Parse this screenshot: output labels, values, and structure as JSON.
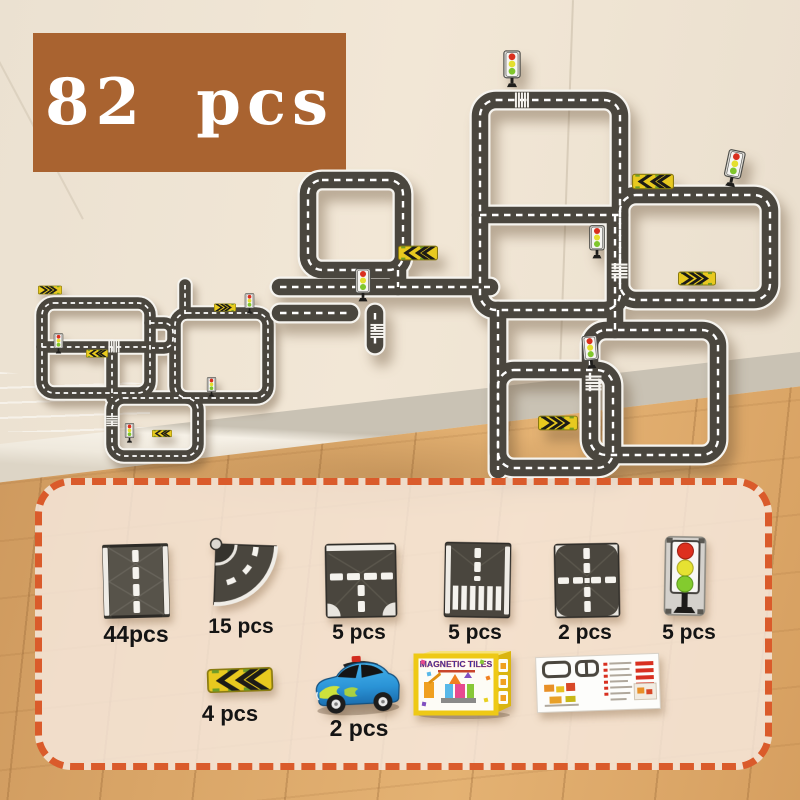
{
  "badge": {
    "label": "82 pcs",
    "bg_color": "#a96330",
    "text_color": "#ffffff"
  },
  "scene": {
    "wall_color": "#ece2d2",
    "skirting_color": "#f3eee3",
    "floor_color": "#d8a263",
    "road_color": "#4a463e",
    "road_line_color": "#ffffff",
    "panel_border_color": "#da5b2b"
  },
  "panel": {
    "items": [
      {
        "id": "straight-road-tile",
        "count": "44pcs"
      },
      {
        "id": "curve-road-tile",
        "count": "15 pcs"
      },
      {
        "id": "t-junction-tile",
        "count": "5 pcs"
      },
      {
        "id": "crosswalk-tile",
        "count": "5 pcs"
      },
      {
        "id": "cross-intersection-tile",
        "count": "2 pcs"
      },
      {
        "id": "traffic-light",
        "count": "5 pcs"
      },
      {
        "id": "chevron-sign",
        "count": "4 pcs"
      },
      {
        "id": "toy-car",
        "count": "2 pcs"
      }
    ],
    "box_title": "MAGNETIC TILES"
  }
}
